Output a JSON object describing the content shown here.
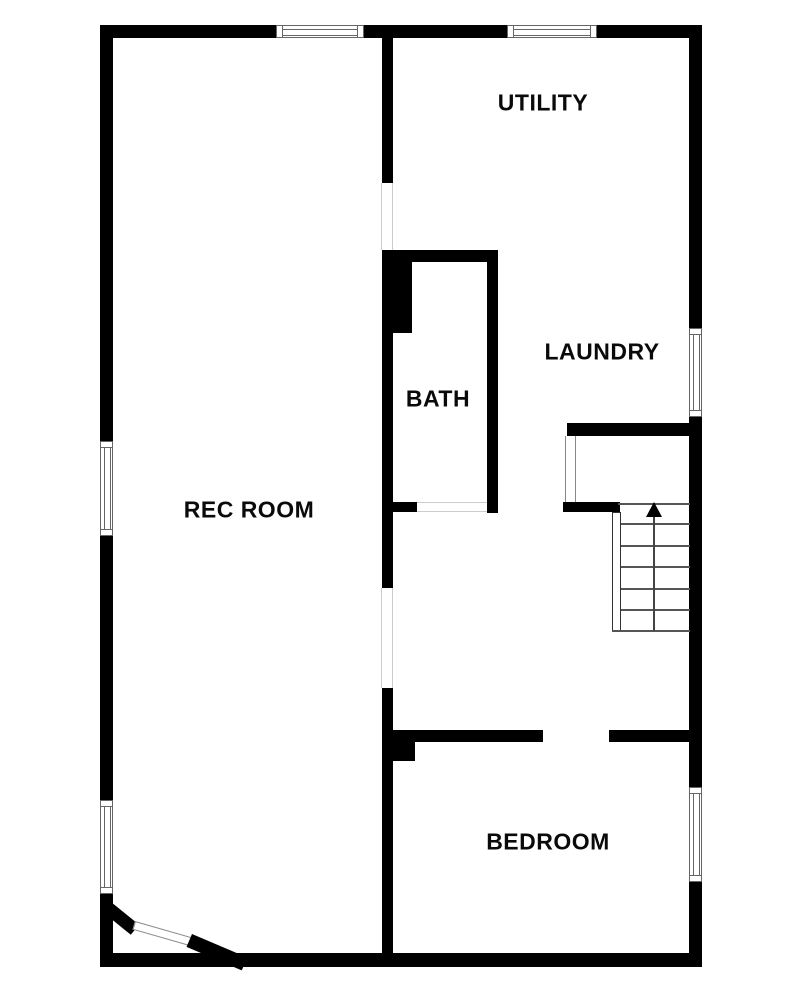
{
  "floor_plan": {
    "rooms": [
      {
        "name": "utility",
        "label": "UTILITY"
      },
      {
        "name": "laundry",
        "label": "LAUNDRY"
      },
      {
        "name": "bath",
        "label": "BATH"
      },
      {
        "name": "rec_room",
        "label": "REC ROOM"
      },
      {
        "name": "bedroom",
        "label": "BEDROOM"
      }
    ],
    "stairs": {
      "arrow_icon": "arrow-up-icon",
      "direction": "up",
      "tread_count": 6
    },
    "colors": {
      "wall": "#000000",
      "background": "#ffffff",
      "stair_lines": "#555555",
      "window_outline": "#666666"
    }
  }
}
